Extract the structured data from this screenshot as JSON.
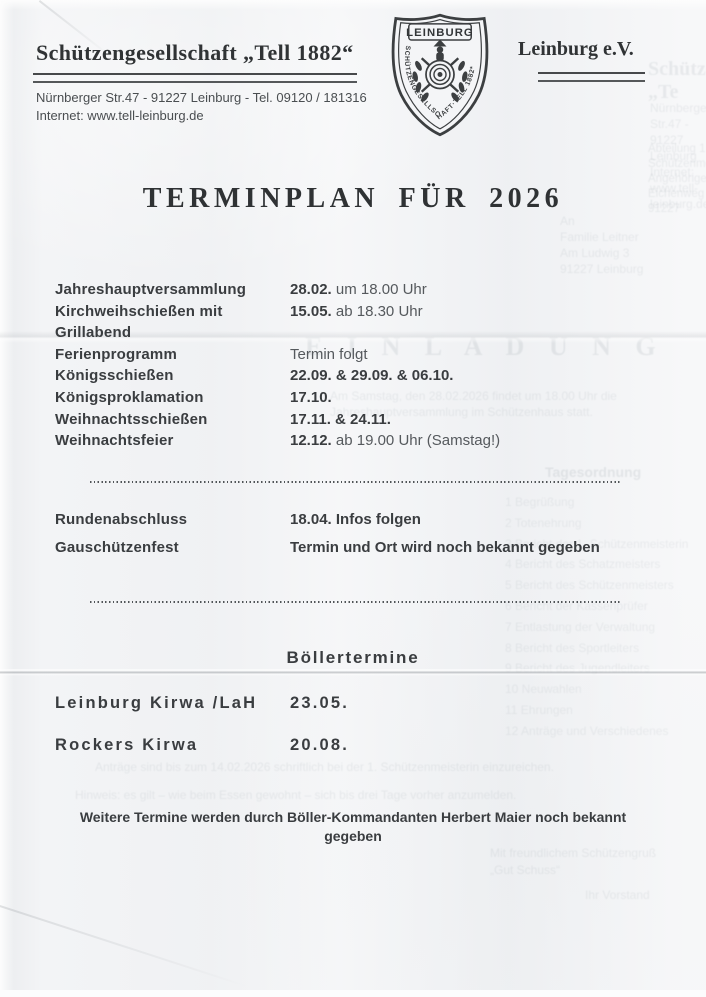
{
  "header": {
    "org_name": "Schützengesellschaft „Tell 1882“",
    "org_right": "Leinburg e.V.",
    "address_line1": "Nürnberger Str.47 - 91227 Leinburg - Tel. 09120 / 181316",
    "address_line2": "Internet: www.tell-leinburg.de",
    "logo": {
      "banner_text": "LEINBURG",
      "ring_text": "SCHÜTZENGESELLSCHAFT·TELL 1882*"
    }
  },
  "title": "TERMINPLAN FÜR 2026",
  "schedule": {
    "lines": [
      {
        "label": "Jahreshauptversammlung",
        "date": "28.02.",
        "note": " um 18.00 Uhr"
      },
      {
        "label": "Kirchweihschießen mit",
        "date": "15.05.",
        "note": " ab 18.30 Uhr"
      },
      {
        "label": "Grillabend",
        "date": "",
        "note": ""
      },
      {
        "label": "Ferienprogramm",
        "date": "",
        "note": "Termin folgt"
      },
      {
        "label": "Königsschießen",
        "date": "22.09. & 29.09. & 06.10.",
        "note": ""
      },
      {
        "label": "Königsproklamation",
        "date": "17.10.",
        "note": ""
      },
      {
        "label": "Weihnachtsschießen",
        "date": "17.11. & 24.11.",
        "note": ""
      },
      {
        "label": "Weihnachtsfeier",
        "date": "12.12.",
        "note": " ab 19.00 Uhr (Samstag!)"
      }
    ]
  },
  "section2": {
    "lines": [
      {
        "label": "Rundenabschluss",
        "date": "18.04.",
        "note": " Infos folgen"
      },
      {
        "label": "Gauschützenfest",
        "date": "",
        "note": "Termin und Ort wird noch bekannt gegeben"
      }
    ]
  },
  "boeller": {
    "heading": "Böllertermine",
    "rows": [
      {
        "label": "Leinburg Kirwa /LaH",
        "date": "23.05."
      },
      {
        "label": "Rockers Kirwa",
        "date": "20.08."
      }
    ]
  },
  "footer": {
    "line1": "Weitere Termine werden durch Böller-Kommandanten Herbert Maier noch bekannt",
    "line2": "gegeben"
  },
  "colors": {
    "ink": "#3a3d40",
    "ink_light": "#55595d",
    "paper": "#f3f4f6"
  },
  "bleed_through": {
    "items": [
      {
        "text": "Schützengesellschaft „Te"
      },
      {
        "text": "Nürnberger Str.47 - 91227 Leinburg\nInternet: www.tell-leinburg.de"
      },
      {
        "text": "Abteilung 1. Schützenmeisterin\nAngehörige, Eichenweg 7, 91227"
      },
      {
        "text": "An\nFamilie Leitner\nAm Ludwig 3\n91227 Leinburg"
      },
      {
        "text": "E I N L A D U N G"
      },
      {
        "text": "Am Samstag, den 28.02.2026 findet um 18.00 Uhr die\nJahreshauptversammlung im Schützenhaus statt."
      },
      {
        "text": "Tagesordnung"
      },
      {
        "text": "1   Begrüßung\n2   Totenehrung\n3   Bericht der 1. Schützenmeisterin\n4   Bericht des Schatzmeisters\n5   Bericht des Schützenmeisters\n6   Bericht der Kassenprüfer\n7   Entlastung der Verwaltung\n8   Bericht des Sportleiters\n9   Bericht des Jugendleiters\n10  Neuwahlen\n11  Ehrungen\n12  Anträge und Verschiedenes"
      },
      {
        "text": "Anträge sind bis zum 14.02.2026 schriftlich bei der 1. Schützenmeisterin einzureichen."
      },
      {
        "text": "Hinweis: es gilt – wie beim Essen gewohnt – sich bis drei Tage vorher anzumelden."
      },
      {
        "text": "Mit freundlichem Schützengruß\n„Gut Schuss“"
      },
      {
        "text": "Ihr Vorstand"
      }
    ]
  }
}
